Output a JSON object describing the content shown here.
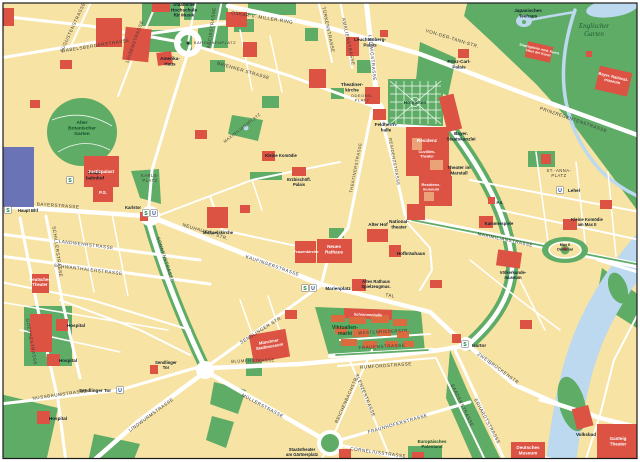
{
  "map": {
    "palette": {
      "bg": "#F7E3A3",
      "park": "#5FAC66",
      "water": "#BDD9EF",
      "road": "#FFFFFF",
      "building": "#DC5243",
      "stall": "#DB6B3E",
      "station": "#6973B6",
      "sbahn": "#0E7C3F",
      "ubahn": "#1D4F9E",
      "frame": "#1a1a1a"
    },
    "labels": [
      {
        "t": "OSKAR-V.-MILLER-RING",
        "x": 262,
        "y": 19,
        "r": 9,
        "c": "st"
      },
      {
        "t": "GABELSBERGERSTRASSE",
        "x": 96,
        "y": 47,
        "r": -9,
        "c": "st"
      },
      {
        "t": "BRIENNER STRASSE",
        "x": 243,
        "y": 72,
        "r": 16,
        "c": "st"
      },
      {
        "t": "ARCISSTRASSE",
        "x": 213,
        "y": 28,
        "r": -82,
        "c": "st"
      },
      {
        "t": "LUISENSTRASSE",
        "x": 136,
        "y": 42,
        "r": -70,
        "c": "st"
      },
      {
        "t": "AUGUSTENSTRASSE",
        "x": 74,
        "y": 28,
        "r": -65,
        "c": "st"
      },
      {
        "t": "TÜRKENSTRASSE",
        "x": 327,
        "y": 30,
        "r": 78,
        "c": "st"
      },
      {
        "t": "AMALIENSTRASSE",
        "x": 347,
        "y": 42,
        "r": 78,
        "c": "st"
      },
      {
        "t": "LUDWIGSTRASSE",
        "x": 371,
        "y": 58,
        "r": 84,
        "c": "st"
      },
      {
        "t": "VON-DER-TANN-STR.",
        "x": 452,
        "y": 40,
        "r": 17,
        "c": "st"
      },
      {
        "t": "PRINZREGENTENSTRASSE",
        "x": 573,
        "y": 121,
        "r": 19,
        "c": "st"
      },
      {
        "t": "KAROLINENPLATZ",
        "x": 215,
        "y": 44,
        "r": 0,
        "c": "st",
        "s": 4.0
      },
      {
        "t": "BAYERSTRASSE",
        "x": 58,
        "y": 207,
        "r": 4,
        "c": "st"
      },
      {
        "t": "LANDWEHRSTRASSE",
        "x": 86,
        "y": 246,
        "r": 7,
        "c": "st"
      },
      {
        "t": "SCHWANTHALERSTRASSE",
        "x": 88,
        "y": 271,
        "r": 7,
        "c": "st"
      },
      {
        "t": "SCHILLERSTRASSE",
        "x": 56,
        "y": 252,
        "r": 82,
        "c": "st"
      },
      {
        "t": "GOETHESTRASSE",
        "x": 30,
        "y": 342,
        "r": 80,
        "c": "st"
      },
      {
        "t": "SONNENSTRASSE",
        "x": 164,
        "y": 260,
        "r": 72,
        "c": "st"
      },
      {
        "t": "NEUHAUSER STR.",
        "x": 205,
        "y": 233,
        "r": 17,
        "c": "st"
      },
      {
        "t": "KAUFINGERSTRASSE",
        "x": 272,
        "y": 267,
        "r": 19,
        "c": "st"
      },
      {
        "t": "TAL",
        "x": 390,
        "y": 297,
        "r": 10,
        "c": "st"
      },
      {
        "t": "SENDLINGER STR.",
        "x": 262,
        "y": 331,
        "r": -32,
        "c": "st"
      },
      {
        "t": "NUSSBAUMSTRASSE",
        "x": 60,
        "y": 396,
        "r": -8,
        "c": "st"
      },
      {
        "t": "LINDWURMSTRASSE",
        "x": 152,
        "y": 416,
        "r": -36,
        "c": "st"
      },
      {
        "t": "MÜLLERSTRASSE",
        "x": 262,
        "y": 407,
        "r": 28,
        "c": "st"
      },
      {
        "t": "BLUMENSTRASSE",
        "x": 253,
        "y": 362,
        "r": -2,
        "c": "st",
        "s": 4.2
      },
      {
        "t": "FRAUENSTRASSE",
        "x": 382,
        "y": 348,
        "r": -3,
        "c": "st"
      },
      {
        "t": "WESTENRIEDERSTR.",
        "x": 384,
        "y": 333,
        "r": -3,
        "c": "st",
        "s": 4.2
      },
      {
        "t": "RUMFORDSTRASSE",
        "x": 386,
        "y": 367,
        "r": -4,
        "c": "st"
      },
      {
        "t": "KLENZESTRASSE",
        "x": 364,
        "y": 396,
        "r": 68,
        "c": "st"
      },
      {
        "t": "REICHENBACHSTR.",
        "x": 348,
        "y": 400,
        "r": -66,
        "c": "st"
      },
      {
        "t": "FRAUNHOFERSTRASSE",
        "x": 398,
        "y": 425,
        "r": -16,
        "c": "st"
      },
      {
        "t": "CORNELIUSSTRASSE",
        "x": 378,
        "y": 454,
        "r": 8,
        "c": "st"
      },
      {
        "t": "BAADERSTRASSE",
        "x": 461,
        "y": 406,
        "r": 64,
        "c": "st"
      },
      {
        "t": "ERHARDTSTRASSE",
        "x": 486,
        "y": 422,
        "r": 62,
        "c": "st"
      },
      {
        "t": "ZWEIBRÜCKENSTR.",
        "x": 498,
        "y": 370,
        "r": 36,
        "c": "st"
      },
      {
        "t": "MAXIMILIANSTRASSE",
        "x": 505,
        "y": 241,
        "r": 12,
        "c": "st"
      },
      {
        "t": "RESIDENZSTRASSE",
        "x": 393,
        "y": 162,
        "r": 80,
        "c": "st",
        "s": 4.2
      },
      {
        "t": "THEATINERSTRASSE",
        "x": 357,
        "y": 168,
        "r": -79,
        "c": "st",
        "s": 4.2
      },
      {
        "t": "MAXIMILIANSPLATZ",
        "x": 243,
        "y": 129,
        "r": -38,
        "c": "st",
        "s": 4.0
      },
      {
        "t": "KARLS-\nPLATZ",
        "x": 150,
        "y": 177,
        "r": 0,
        "c": "st",
        "s": 4.2
      },
      {
        "t": "ST.-ANNA-\nPLATZ",
        "x": 559,
        "y": 172,
        "r": 0,
        "c": "st",
        "s": 4.2
      },
      {
        "t": "ODEONS-\nPLATZ",
        "x": 362,
        "y": 97,
        "r": 0,
        "c": "st",
        "s": 4.0
      },
      {
        "t": "Hofgarten",
        "x": 415,
        "y": 104,
        "r": 0,
        "c": "park"
      },
      {
        "t": "Alter\nBotanischer\nGarten",
        "x": 82,
        "y": 124,
        "r": 0,
        "c": "park"
      },
      {
        "t": "Viktualien-\nmarkt",
        "x": 345,
        "y": 329,
        "r": 0,
        "c": "park",
        "s": 5.2
      },
      {
        "t": "Europäisches\nPatentamt",
        "x": 432,
        "y": 443,
        "r": 0,
        "c": "park",
        "s": 4.4
      },
      {
        "t": "Englischer\nGarten",
        "x": 594,
        "y": 28,
        "r": 0,
        "c": "parki"
      },
      {
        "t": "Staatliche\nHochschule\nfür Musik",
        "x": 184,
        "y": 6,
        "r": 0,
        "c": "pl"
      },
      {
        "t": "Amerika-\nHaus",
        "x": 170,
        "y": 60,
        "r": 0,
        "c": "pl"
      },
      {
        "t": "Leuchtenberg-\nPalais",
        "x": 370,
        "y": 41,
        "r": 0,
        "c": "pl"
      },
      {
        "t": "Prinz-Carl-\nPalais",
        "x": 459,
        "y": 63,
        "r": 0,
        "c": "pl"
      },
      {
        "t": "Japanisches\nTeehaus",
        "x": 528,
        "y": 12,
        "r": 0,
        "c": "pl"
      },
      {
        "t": "Theatiner-\nkirche",
        "x": 352,
        "y": 86,
        "r": 0,
        "c": "pl"
      },
      {
        "t": "Feldherrn-\nhalle",
        "x": 386,
        "y": 126,
        "r": 0,
        "c": "pl"
      },
      {
        "t": "Bayer.\nStaatskanzlei",
        "x": 461,
        "y": 135,
        "r": 0,
        "c": "pl"
      },
      {
        "t": "Theater im\nMarstall",
        "x": 459,
        "y": 169,
        "r": 0,
        "c": "pl"
      },
      {
        "t": "National-\ntheater",
        "x": 399,
        "y": 223,
        "r": 0,
        "c": "pl"
      },
      {
        "t": "Alter Hof",
        "x": 378,
        "y": 226,
        "r": 0,
        "c": "pl"
      },
      {
        "t": "Hofbräuhaus",
        "x": 411,
        "y": 255,
        "r": 0,
        "c": "pl"
      },
      {
        "t": "Altes Rathaus\nSpielzeugmus.",
        "x": 376,
        "y": 283,
        "r": 0,
        "c": "pl",
        "s": 4.2
      },
      {
        "t": "Michaelskirche",
        "x": 218,
        "y": 234,
        "r": 0,
        "c": "pl",
        "s": 4.2
      },
      {
        "t": "Karlstor",
        "x": 133,
        "y": 209,
        "r": 0,
        "c": "pl",
        "s": 4.2
      },
      {
        "t": "Kleine Komödie",
        "x": 281,
        "y": 157,
        "r": 0,
        "c": "pl",
        "s": 4.2
      },
      {
        "t": "Erzbischöfl.\nPalais",
        "x": 299,
        "y": 181,
        "r": 0,
        "c": "pl",
        "s": 4.2
      },
      {
        "t": "Hospital",
        "x": 76,
        "y": 327,
        "r": 0,
        "c": "pl"
      },
      {
        "t": "Hospital",
        "x": 68,
        "y": 362,
        "r": 0,
        "c": "pl"
      },
      {
        "t": "Hospital",
        "x": 58,
        "y": 420,
        "r": 0,
        "c": "pl"
      },
      {
        "t": "Sendlinger\nTor",
        "x": 166,
        "y": 364,
        "r": 0,
        "c": "pl",
        "s": 4.2
      },
      {
        "t": "Sendlinger Tor",
        "x": 95,
        "y": 392,
        "r": 0,
        "c": "pl"
      },
      {
        "t": "Haupt-\nbahnhof",
        "x": 95,
        "y": 174,
        "r": 0,
        "c": "pl"
      },
      {
        "t": "Haupt Bhf",
        "x": 28,
        "y": 212,
        "r": 0,
        "c": "pl",
        "s": 4.2
      },
      {
        "t": "Marienplatz",
        "x": 338,
        "y": 290,
        "r": 0,
        "c": "pl"
      },
      {
        "t": "Lehel",
        "x": 574,
        "y": 192,
        "r": 0,
        "c": "pl"
      },
      {
        "t": "Isartor",
        "x": 479,
        "y": 347,
        "r": 0,
        "c": "pl"
      },
      {
        "t": "Kammerspiele",
        "x": 499,
        "y": 225,
        "r": 0,
        "c": "pl",
        "s": 4.2
      },
      {
        "t": "Kleine Komödie\nam Max II",
        "x": 587,
        "y": 221,
        "r": 0,
        "c": "pl",
        "s": 4.2
      },
      {
        "t": "Max II\nDenkmal",
        "x": 565,
        "y": 246,
        "r": 0,
        "c": "pl",
        "s": 3.8
      },
      {
        "t": "Völkerkunde-\nmuseum",
        "x": 513,
        "y": 274,
        "r": 0,
        "c": "pl",
        "s": 4.2
      },
      {
        "t": "Volksbad",
        "x": 586,
        "y": 436,
        "r": 0,
        "c": "pl"
      },
      {
        "t": "Staatstheater\nam Gärtnerplatz",
        "x": 302,
        "y": 451,
        "r": 0,
        "c": "pl",
        "s": 4.2
      },
      {
        "t": "P.S.",
        "x": 500,
        "y": 204,
        "r": 0,
        "c": "pl",
        "s": 4.0
      },
      {
        "t": "Justizpalast",
        "x": 101,
        "y": 173,
        "r": 0,
        "c": "plw"
      },
      {
        "t": "Residenz",
        "x": 427,
        "y": 142,
        "r": 0,
        "c": "plw"
      },
      {
        "t": "Cuvilliés-\nTheater",
        "x": 427,
        "y": 153,
        "r": 0,
        "c": "plw",
        "s": 3.8
      },
      {
        "t": "Residenz-\nmuseum",
        "x": 431,
        "y": 186,
        "r": 0,
        "c": "plw",
        "s": 4.0
      },
      {
        "t": "Neues\nRathaus",
        "x": 334,
        "y": 248,
        "r": 0,
        "c": "plw"
      },
      {
        "t": "Frauenkirche",
        "x": 306,
        "y": 253,
        "r": 0,
        "c": "plw",
        "s": 4.0
      },
      {
        "t": "Münchner\nStadtmuseum",
        "x": 269,
        "y": 343,
        "r": -10,
        "c": "plw",
        "s": 4.2
      },
      {
        "t": "Deutsches\nTheater",
        "x": 40,
        "y": 281,
        "r": 0,
        "c": "plw",
        "s": 4.2
      },
      {
        "t": "Deutsches\nMuseum",
        "x": 528,
        "y": 449,
        "r": 0,
        "c": "plw"
      },
      {
        "t": "Gasteig\nTheater",
        "x": 618,
        "y": 440,
        "r": 0,
        "c": "plw"
      },
      {
        "t": "Staatsgalerie mod. Kunst\nHaus der Kunst",
        "x": 539,
        "y": 50,
        "r": 13,
        "c": "plw",
        "s": 3.4
      },
      {
        "t": "Bayer. National-\nmuseum",
        "x": 613,
        "y": 78,
        "r": 13,
        "c": "plw",
        "s": 4.0
      },
      {
        "t": "Schrannenhalle",
        "x": 368,
        "y": 316,
        "r": 2,
        "c": "plw",
        "s": 3.8
      },
      {
        "t": "P.S.",
        "x": 103,
        "y": 194,
        "r": 0,
        "c": "plw",
        "s": 4.4
      }
    ],
    "transit": [
      {
        "k": "S",
        "x": 70,
        "y": 180
      },
      {
        "k": "S",
        "x": 8,
        "y": 210
      },
      {
        "k": "S",
        "x": 146,
        "y": 213
      },
      {
        "k": "U",
        "x": 154,
        "y": 213
      },
      {
        "k": "S",
        "x": 305,
        "y": 288
      },
      {
        "k": "U",
        "x": 313,
        "y": 288
      },
      {
        "k": "U",
        "x": 120,
        "y": 390
      },
      {
        "k": "S",
        "x": 465,
        "y": 344
      },
      {
        "k": "U",
        "x": 560,
        "y": 190
      }
    ]
  }
}
